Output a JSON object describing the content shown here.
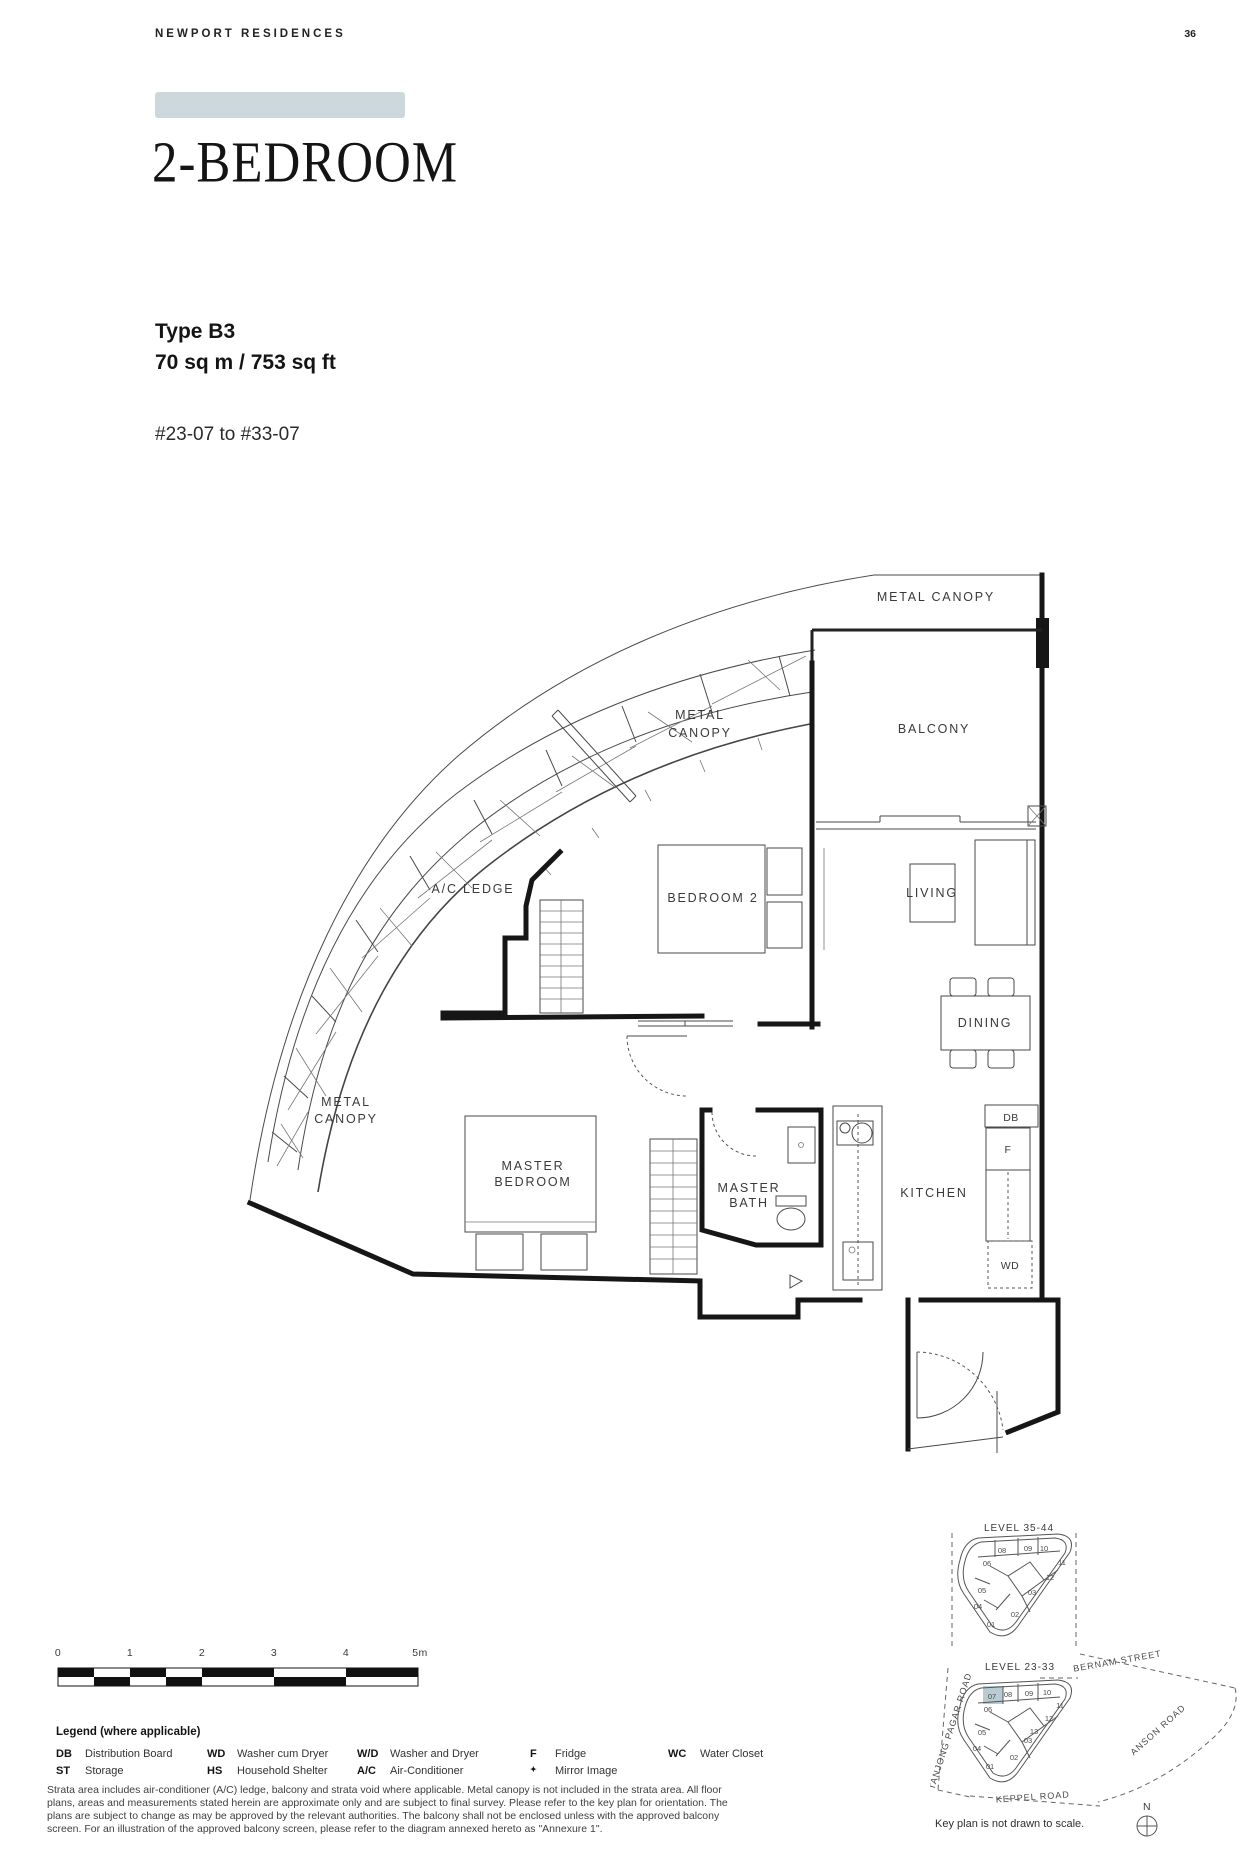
{
  "header": {
    "brand": "NEWPORT RESIDENCES",
    "page": "36"
  },
  "title_block": {
    "title": "2-BEDROOM",
    "type": "Type B3",
    "area": "70 sq m / 753 sq ft",
    "unit_range": "#23-07 to #33-07"
  },
  "colors": {
    "banner": "#ccd8dc",
    "keyplan_highlight": "#b9ccd3"
  },
  "plan": {
    "metal_canopy_top": "METAL CANOPY",
    "balcony": "BALCONY",
    "metal_canopy_mid": [
      "METAL",
      "CANOPY"
    ],
    "ac_ledge": "A/C LEDGE",
    "bedroom2": "BEDROOM 2",
    "living": "LIVING",
    "dining": "DINING",
    "metal_canopy_bottom": [
      "METAL",
      "CANOPY"
    ],
    "master_bedroom": [
      "MASTER",
      "BEDROOM"
    ],
    "master_bath": [
      "MASTER",
      "BATH"
    ],
    "kitchen": "KITCHEN",
    "db": "DB",
    "fridge": "F",
    "wd": "WD"
  },
  "scale_bar": {
    "labels": [
      "0",
      "1",
      "2",
      "3",
      "4",
      "5m"
    ]
  },
  "legend": {
    "title": "Legend (where applicable)",
    "items": [
      {
        "abbr": "DB",
        "desc": "Distribution Board"
      },
      {
        "abbr": "ST",
        "desc": "Storage"
      },
      {
        "abbr": "WD",
        "desc": "Washer cum Dryer"
      },
      {
        "abbr": "HS",
        "desc": "Household Shelter"
      },
      {
        "abbr": "W/D",
        "desc": "Washer and Dryer"
      },
      {
        "abbr": "A/C",
        "desc": "Air-Conditioner"
      },
      {
        "abbr": "F",
        "desc": "Fridge"
      },
      {
        "abbr": "✦",
        "desc": "Mirror Image"
      },
      {
        "abbr": "WC",
        "desc": "Water Closet"
      }
    ]
  },
  "disclaimer": [
    "Strata area includes air-conditioner (A/C) ledge, balcony and strata void where applicable. Metal canopy is not included in the strata area. All floor",
    "plans, areas and measurements stated herein are approximate only and are subject to final survey. Please refer to the key plan for orientation. The",
    "plans are subject to change as may be approved by the relevant authorities. The balcony shall not be enclosed unless with the approved balcony",
    "screen. For an illustration of the approved balcony screen, please refer to the diagram annexed hereto as \"Annexure 1\"."
  ],
  "keyplan": {
    "note": "Key plan is not drawn to scale.",
    "compass": "N",
    "upper": {
      "level": "LEVEL 35-44",
      "units": [
        "08",
        "09",
        "10",
        "06",
        "11",
        "05",
        "12",
        "03",
        "04",
        "02",
        "01"
      ]
    },
    "lower": {
      "level": "LEVEL 23-33",
      "highlighted_unit": "07",
      "units": [
        "07",
        "08",
        "09",
        "10",
        "06",
        "11",
        "12",
        "13",
        "05",
        "03",
        "04",
        "02",
        "01"
      ]
    },
    "roads": {
      "bernam": "BERNAM STREET",
      "tanjong_pagar": "TANJONG PAGAR ROAD",
      "anson": "ANSON ROAD",
      "keppel": "KEPPEL ROAD"
    }
  }
}
